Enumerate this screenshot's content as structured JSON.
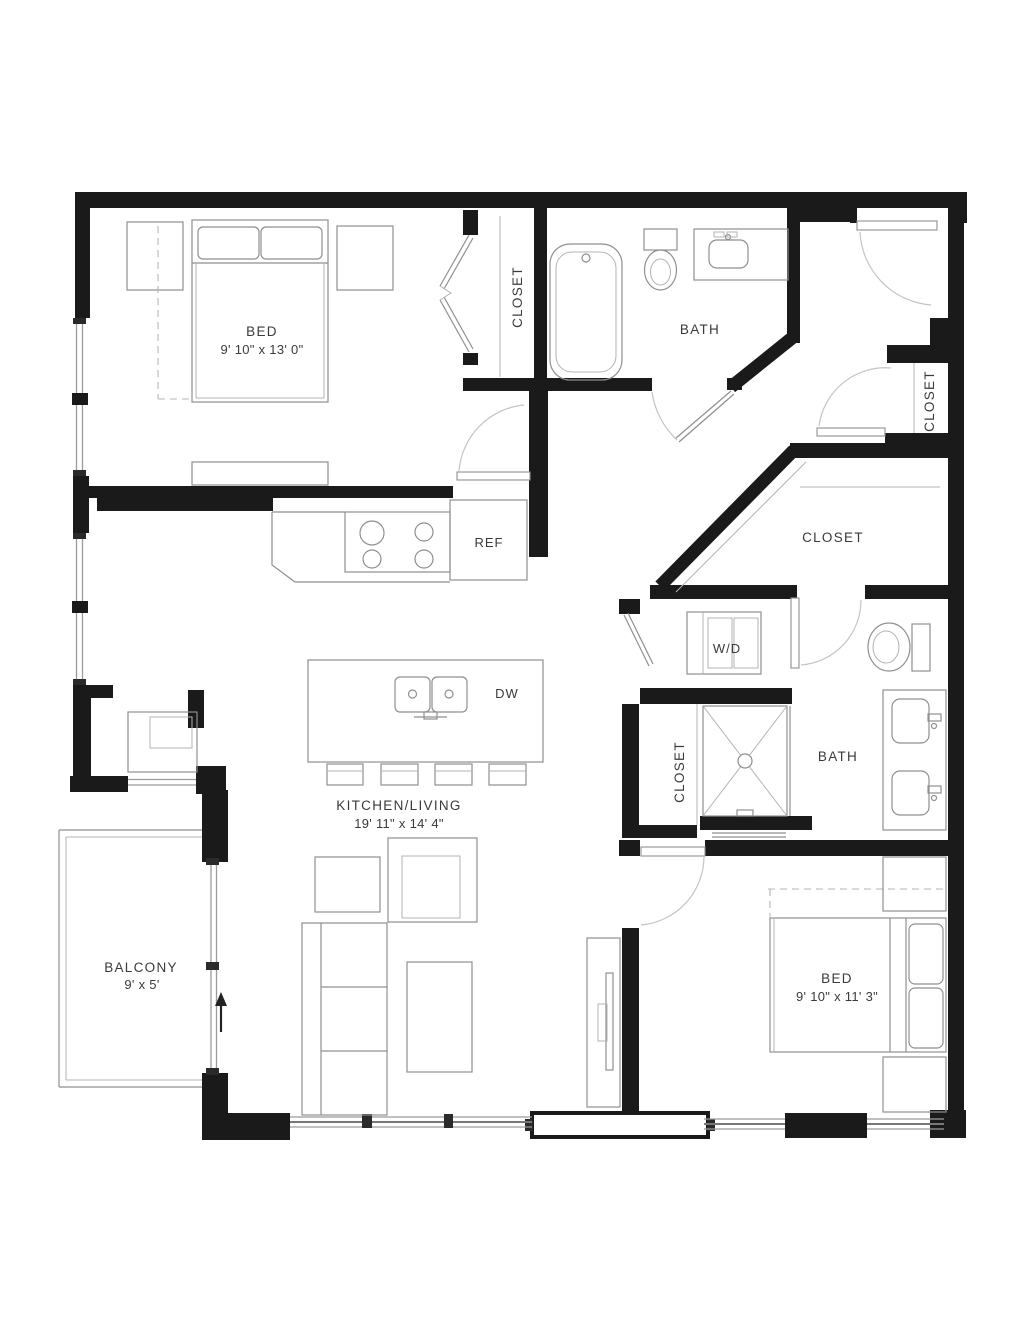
{
  "floorplan": {
    "title": "2 Bed / 2 Bath Apartment Floor Plan",
    "rooms": [
      {
        "id": "bedroom-1",
        "label": "BED",
        "dims": "9' 10\" x 13' 0\""
      },
      {
        "id": "closet-bed-1",
        "label": "CLOSET"
      },
      {
        "id": "bath-1",
        "label": "BATH"
      },
      {
        "id": "entry-closet",
        "label": "CLOSET"
      },
      {
        "id": "walkin-closet",
        "label": "CLOSET"
      },
      {
        "id": "laundry",
        "label": "W/D"
      },
      {
        "id": "kitchen-living",
        "label": "KITCHEN/LIVING",
        "dims": "19' 11\" x 14' 4\""
      },
      {
        "id": "hall-closet",
        "label": "CLOSET"
      },
      {
        "id": "bath-2",
        "label": "BATH"
      },
      {
        "id": "bedroom-2",
        "label": "BED",
        "dims": "9' 10\" x 11' 3\""
      },
      {
        "id": "balcony",
        "label": "BALCONY",
        "dims": "9' x 5'"
      }
    ],
    "appliances": {
      "refrigerator": "REF",
      "dishwasher": "DW"
    },
    "colors": {
      "wall": "#1a1a1a",
      "furniture": "#8f8f8f",
      "text": "#3a3a3a",
      "background": "#ffffff"
    }
  }
}
